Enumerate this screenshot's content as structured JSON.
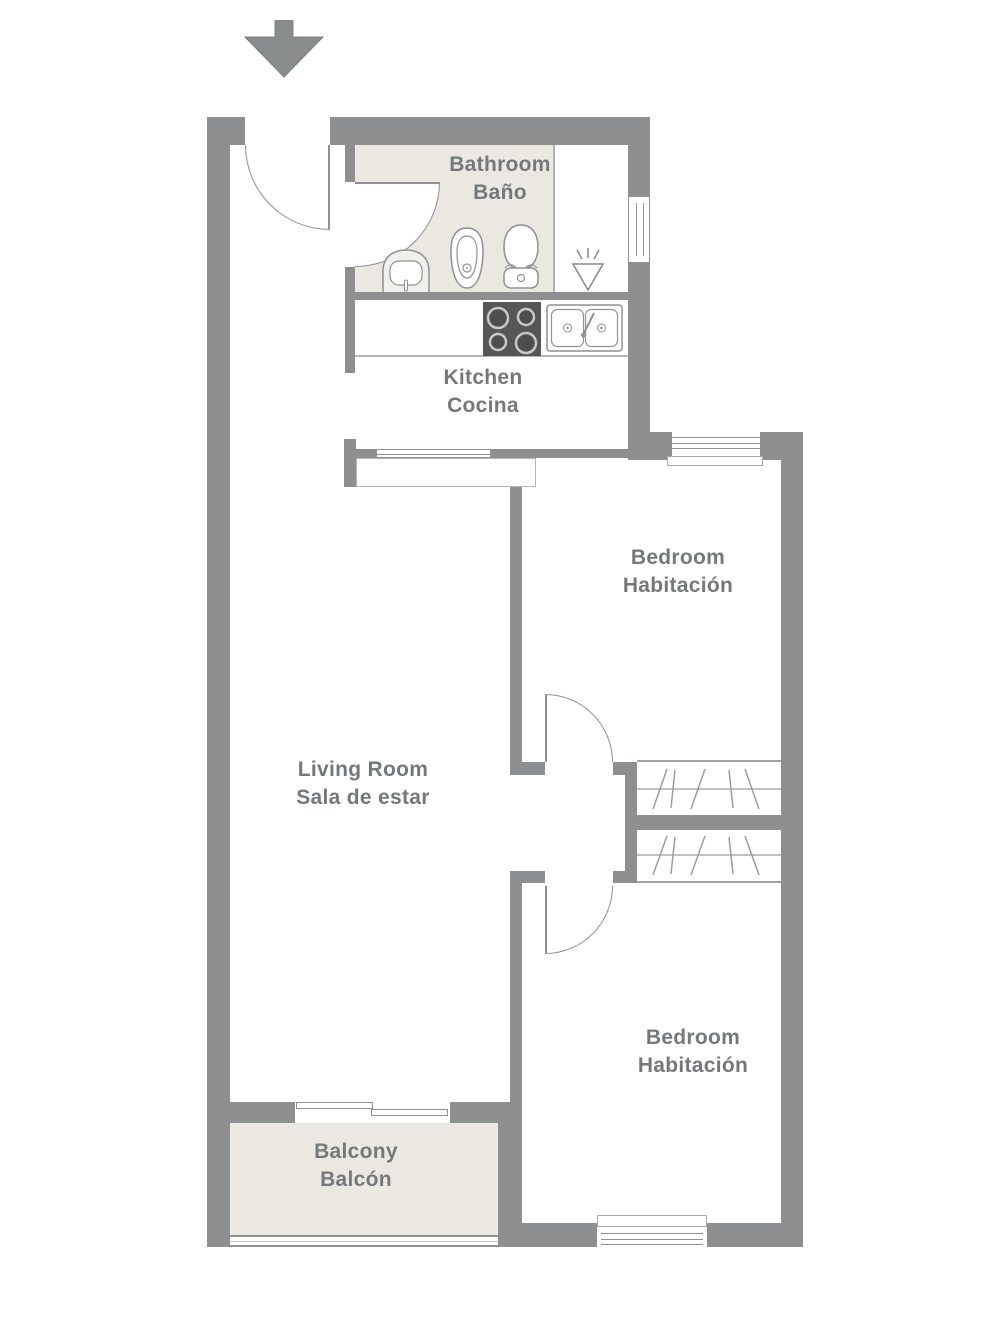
{
  "rooms": {
    "bathroom": {
      "en": "Bathroom",
      "es": "Baño"
    },
    "kitchen": {
      "en": "Kitchen",
      "es": "Cocina"
    },
    "bedroom_top": {
      "en": "Bedroom",
      "es": "Habitación"
    },
    "living_room": {
      "en": "Living Room",
      "es": "Sala de estar"
    },
    "bedroom_bottom": {
      "en": "Bedroom",
      "es": "Habitación"
    },
    "balcony": {
      "en": "Balcony",
      "es": "Balcón"
    }
  },
  "icons": {
    "entrance_arrow": "down-arrow",
    "shower": "shower-head",
    "bathroom_fixtures": [
      "washbasin",
      "bidet",
      "toilet"
    ],
    "kitchen_fixtures": [
      "stove-4-burner",
      "double-sink"
    ],
    "wardrobes": 2
  },
  "colors": {
    "wall": "#8d8f90",
    "room_fill": "#ebe8e2",
    "label_text": "#75787b",
    "stove": "#565656",
    "outline": "#8f9192"
  }
}
